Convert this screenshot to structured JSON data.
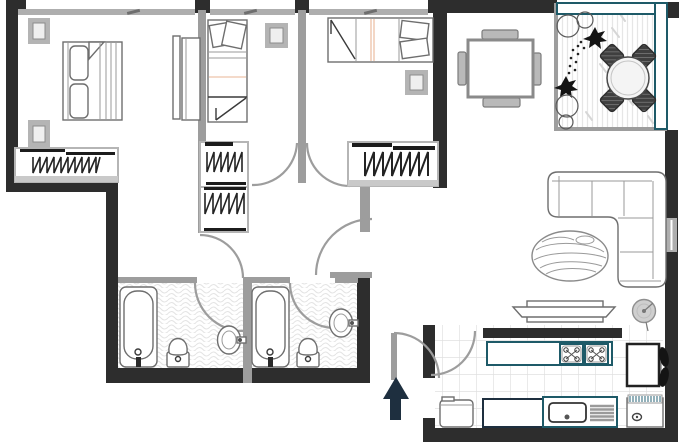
{
  "plan": {
    "kind": "apartment-floor-plan",
    "entrance_arrow": {
      "direction": "up"
    },
    "rooms": [
      {
        "name": "bedroom-1",
        "furniture": [
          "double-bed",
          "pillow",
          "pillow",
          "nightstand",
          "nightstand",
          "closet-with-hangers"
        ]
      },
      {
        "name": "bedroom-2",
        "furniture": [
          "single-bed",
          "pillow",
          "pillow",
          "nightstand",
          "wardrobe",
          "closet-with-hangers",
          "closet-with-hangers"
        ]
      },
      {
        "name": "bedroom-3",
        "furniture": [
          "single-bed",
          "pillow",
          "pillow",
          "nightstand",
          "closet-with-hangers"
        ]
      },
      {
        "name": "bathroom-1",
        "furniture": [
          "bathtub",
          "toilet",
          "sink"
        ]
      },
      {
        "name": "bathroom-2",
        "furniture": [
          "bathtub",
          "toilet",
          "sink"
        ]
      },
      {
        "name": "dining-area",
        "furniture": [
          "square-table",
          "chair",
          "chair",
          "chair",
          "chair"
        ]
      },
      {
        "name": "living-area",
        "furniture": [
          "corner-sofa",
          "oval-rug",
          "tv-console",
          "floor-lamp"
        ]
      },
      {
        "name": "balcony",
        "furniture": [
          "round-table",
          "chair",
          "chair",
          "chair",
          "chair",
          "plants"
        ]
      },
      {
        "name": "kitchen",
        "furniture": [
          "counter-with-two-burners",
          "fridge",
          "plant",
          "base-cabinet",
          "counter",
          "sink-with-drainer",
          "washing-machine"
        ]
      }
    ]
  },
  "colors": {
    "paper": "#ffffff",
    "wall_dark": "#2d2d2d",
    "wall_gray": "#9d9d9d",
    "window_gray": "#aeaeae",
    "furniture_outline": "#6e6e6e",
    "furniture_light": "#b9b9b9",
    "accent_teal": "#1e5a68",
    "accent_navy": "#1e2f3f",
    "floor_texture": "#e3e3e3",
    "plant_black": "#141414",
    "soft_peach": "#f0cdb8"
  }
}
